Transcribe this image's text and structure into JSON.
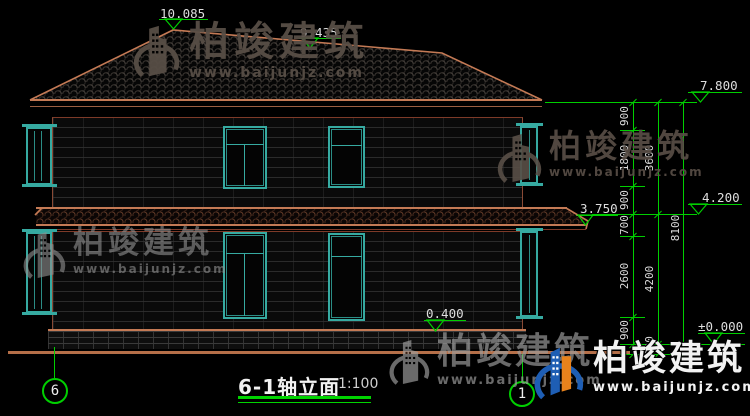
{
  "drawing": {
    "title": "6-1轴立面",
    "scale": "1:100",
    "grid_left": "6",
    "grid_right": "1"
  },
  "elevations": {
    "peak": "10.085",
    "ridge": "9.435",
    "eave": "7.800",
    "second_floor": "4.200",
    "canopy": "3.750",
    "plinth": "0.400",
    "zero": "±0.000"
  },
  "dimensions": {
    "chain": [
      "900",
      "1800",
      "900",
      "700",
      "2600",
      "900"
    ],
    "mid": [
      "3600",
      "4200",
      "300"
    ],
    "total": "8100"
  },
  "watermark": {
    "brand": "柏竣建筑",
    "url": "www.baijunjz.com"
  },
  "colors": {
    "line_tan": "#c47a55",
    "accent_green": "#00cf00",
    "window_teal": "#36aaa1",
    "text_white": "#dedede",
    "watermark_smoke": "#584e46",
    "watermark_gray": "#8f8f8f",
    "logo_blue": "#1e5eb4",
    "logo_orange": "#e8821c"
  }
}
